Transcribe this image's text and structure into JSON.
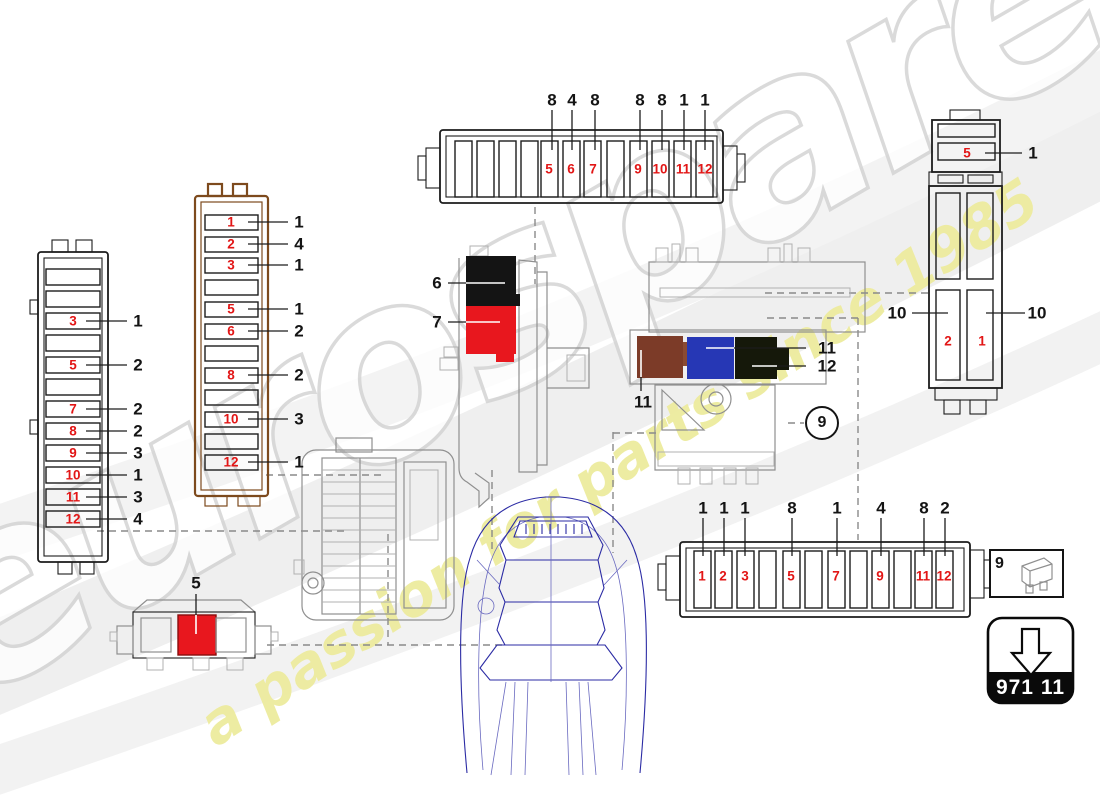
{
  "watermark": {
    "brand": "eurospares",
    "tagline": "a passion for parts since 1985",
    "brand_color": "#d2d2d2",
    "tagline_color": "#edeb9e"
  },
  "part_badge": {
    "code": "971 11"
  },
  "legend": {
    "ref": "9",
    "icon": "blade-fuse-icon"
  },
  "colors": {
    "callout_text": "#141414",
    "fuse_number_text": "#e21616",
    "brown_box_outline": "#7d4a1d",
    "relay_black": "#141414",
    "relay_red": "#e8171e",
    "relay_brown": "#7c3b28",
    "relay_blue": "#2637b5",
    "relay_dark_olive": "#15180a",
    "fuse_red_slot": "#e8171e",
    "car_line": "#2b2ba4"
  },
  "fuse_boxes": [
    {
      "id": "top-fuse-box",
      "orientation": "horizontal",
      "fuses": [
        {
          "label": "5",
          "x": 549,
          "y": 169
        },
        {
          "label": "6",
          "x": 571,
          "y": 169
        },
        {
          "label": "7",
          "x": 593,
          "y": 169
        },
        {
          "label": "9",
          "x": 638,
          "y": 169
        },
        {
          "label": "10",
          "x": 660,
          "y": 169
        },
        {
          "label": "11",
          "x": 683,
          "y": 169
        },
        {
          "label": "12",
          "x": 705,
          "y": 169
        }
      ],
      "callouts": [
        {
          "label": "8",
          "x": 552,
          "y": 100
        },
        {
          "label": "4",
          "x": 572,
          "y": 100
        },
        {
          "label": "8",
          "x": 595,
          "y": 100
        },
        {
          "label": "8",
          "x": 640,
          "y": 100
        },
        {
          "label": "8",
          "x": 662,
          "y": 100
        },
        {
          "label": "1",
          "x": 684,
          "y": 100
        },
        {
          "label": "1",
          "x": 705,
          "y": 100
        }
      ]
    },
    {
      "id": "right-fuse-box",
      "orientation": "vertical",
      "fuses": [
        {
          "label": "5",
          "x": 967,
          "y": 153
        },
        {
          "label": "2",
          "x": 948,
          "y": 341
        },
        {
          "label": "1",
          "x": 982,
          "y": 341
        }
      ],
      "callouts": [
        {
          "label": "1",
          "x": 1033,
          "y": 153
        },
        {
          "label": "10",
          "x": 897,
          "y": 313
        },
        {
          "label": "10",
          "x": 1037,
          "y": 313
        }
      ]
    },
    {
      "id": "left-fuse-box",
      "orientation": "vertical",
      "fuses": [
        {
          "label": "3",
          "x": 73,
          "y": 321
        },
        {
          "label": "5",
          "x": 73,
          "y": 365
        },
        {
          "label": "7",
          "x": 73,
          "y": 409
        },
        {
          "label": "8",
          "x": 73,
          "y": 431
        },
        {
          "label": "9",
          "x": 73,
          "y": 453
        },
        {
          "label": "10",
          "x": 73,
          "y": 475
        },
        {
          "label": "11",
          "x": 73,
          "y": 497
        },
        {
          "label": "12",
          "x": 73,
          "y": 519
        }
      ],
      "callouts": [
        {
          "label": "1",
          "x": 138,
          "y": 321
        },
        {
          "label": "2",
          "x": 138,
          "y": 365
        },
        {
          "label": "2",
          "x": 138,
          "y": 409
        },
        {
          "label": "2",
          "x": 138,
          "y": 431
        },
        {
          "label": "3",
          "x": 138,
          "y": 453
        },
        {
          "label": "1",
          "x": 138,
          "y": 475
        },
        {
          "label": "3",
          "x": 138,
          "y": 497
        },
        {
          "label": "4",
          "x": 138,
          "y": 519
        }
      ]
    },
    {
      "id": "brown-fuse-box",
      "orientation": "vertical",
      "fuses": [
        {
          "label": "1",
          "x": 231,
          "y": 222
        },
        {
          "label": "2",
          "x": 231,
          "y": 244
        },
        {
          "label": "3",
          "x": 231,
          "y": 265
        },
        {
          "label": "5",
          "x": 231,
          "y": 309
        },
        {
          "label": "6",
          "x": 231,
          "y": 331
        },
        {
          "label": "8",
          "x": 231,
          "y": 375
        },
        {
          "label": "10",
          "x": 231,
          "y": 419
        },
        {
          "label": "12",
          "x": 231,
          "y": 462
        }
      ],
      "callouts": [
        {
          "label": "1",
          "x": 299,
          "y": 222
        },
        {
          "label": "4",
          "x": 299,
          "y": 244
        },
        {
          "label": "1",
          "x": 299,
          "y": 265
        },
        {
          "label": "1",
          "x": 299,
          "y": 309
        },
        {
          "label": "2",
          "x": 299,
          "y": 331
        },
        {
          "label": "2",
          "x": 299,
          "y": 375
        },
        {
          "label": "3",
          "x": 299,
          "y": 419
        },
        {
          "label": "1",
          "x": 299,
          "y": 462
        }
      ]
    },
    {
      "id": "bottom-fuse-box",
      "orientation": "horizontal",
      "fuses": [
        {
          "label": "1",
          "x": 702,
          "y": 576
        },
        {
          "label": "2",
          "x": 723,
          "y": 576
        },
        {
          "label": "3",
          "x": 745,
          "y": 576
        },
        {
          "label": "5",
          "x": 791,
          "y": 576
        },
        {
          "label": "7",
          "x": 836,
          "y": 576
        },
        {
          "label": "9",
          "x": 880,
          "y": 576
        },
        {
          "label": "11",
          "x": 923,
          "y": 576
        },
        {
          "label": "12",
          "x": 944,
          "y": 576
        }
      ],
      "callouts": [
        {
          "label": "1",
          "x": 703,
          "y": 508
        },
        {
          "label": "1",
          "x": 724,
          "y": 508
        },
        {
          "label": "1",
          "x": 745,
          "y": 508
        },
        {
          "label": "8",
          "x": 792,
          "y": 508
        },
        {
          "label": "1",
          "x": 837,
          "y": 508
        },
        {
          "label": "4",
          "x": 881,
          "y": 508
        },
        {
          "label": "8",
          "x": 924,
          "y": 508
        },
        {
          "label": "2",
          "x": 945,
          "y": 508
        }
      ]
    },
    {
      "id": "auxiliary-fuse-box",
      "orientation": "horizontal",
      "fuses": [],
      "callouts": [
        {
          "label": "5",
          "x": 196,
          "y": 583
        }
      ]
    }
  ],
  "relay_callouts": [
    {
      "label": "6",
      "x": 437,
      "y": 283
    },
    {
      "label": "7",
      "x": 437,
      "y": 322
    },
    {
      "label": "11",
      "x": 643,
      "y": 402
    },
    {
      "label": "11",
      "x": 827,
      "y": 348
    },
    {
      "label": "12",
      "x": 827,
      "y": 366
    },
    {
      "label": "9",
      "x": 822,
      "y": 423,
      "circled": true
    }
  ]
}
